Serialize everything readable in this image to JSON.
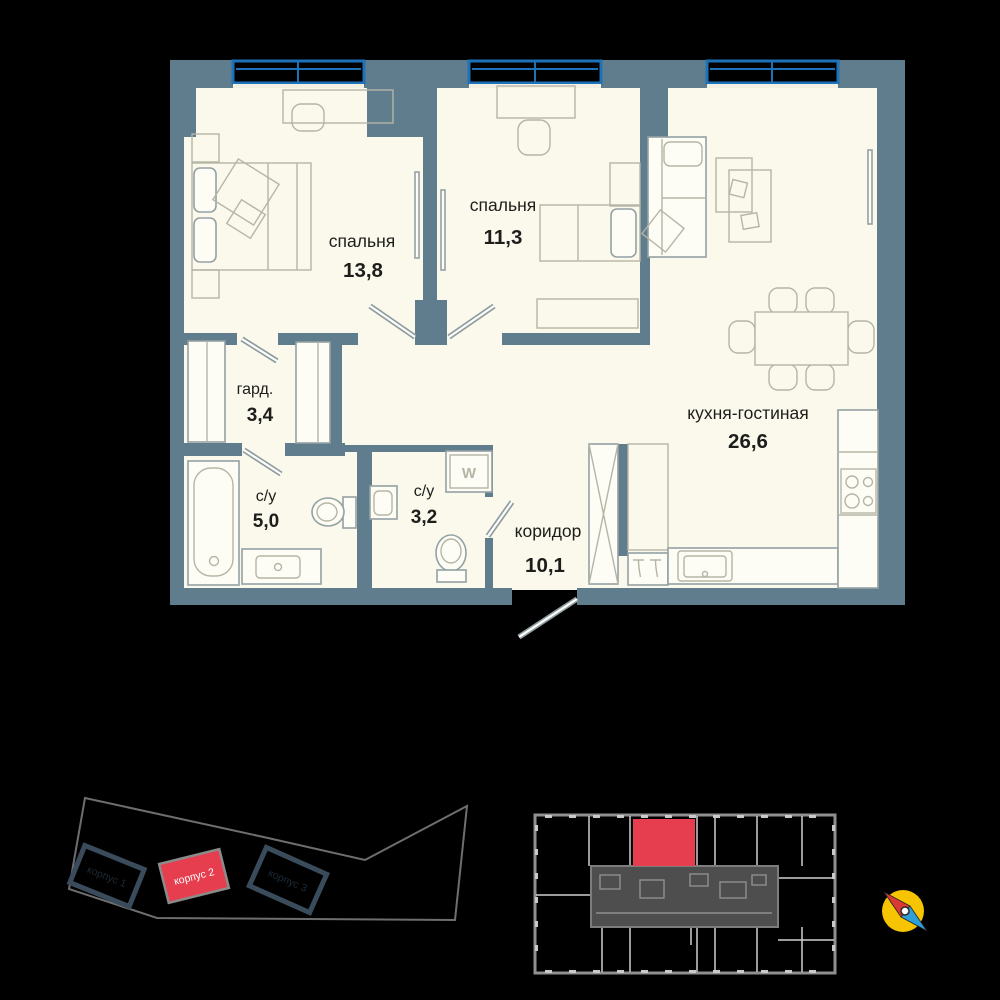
{
  "floor_plan": {
    "rooms": [
      {
        "id": "bedroom-1",
        "name": "спальня",
        "area": "13,8"
      },
      {
        "id": "bedroom-2",
        "name": "спальня",
        "area": "11,3"
      },
      {
        "id": "kitchen-living",
        "name": "кухня-гостиная",
        "area": "26,6"
      },
      {
        "id": "wardrobe",
        "name": "гард.",
        "area": "3,4"
      },
      {
        "id": "bathroom-1",
        "name": "с/у",
        "area": "5,0"
      },
      {
        "id": "bathroom-2",
        "name": "с/у",
        "area": "3,2"
      },
      {
        "id": "corridor",
        "name": "коридор",
        "area": "10,1"
      }
    ],
    "washing_machine_label": "W"
  },
  "site_plan": {
    "buildings": [
      {
        "label": "корпус 1",
        "highlighted": false
      },
      {
        "label": "корпус 2",
        "highlighted": true
      },
      {
        "label": "корпус 3",
        "highlighted": false
      }
    ]
  },
  "floor_overview": {
    "selected_unit_color": "#e63d4f"
  },
  "colors": {
    "background": "#000000",
    "wall": "#5f7d8d",
    "floor": "#fbf9ec",
    "window_frame": "#1d72b9",
    "accent_red": "#e63d4f",
    "compass_yellow": "#f6c400",
    "compass_needle_red": "#d93a35",
    "compass_needle_blue": "#2e9fd7"
  }
}
